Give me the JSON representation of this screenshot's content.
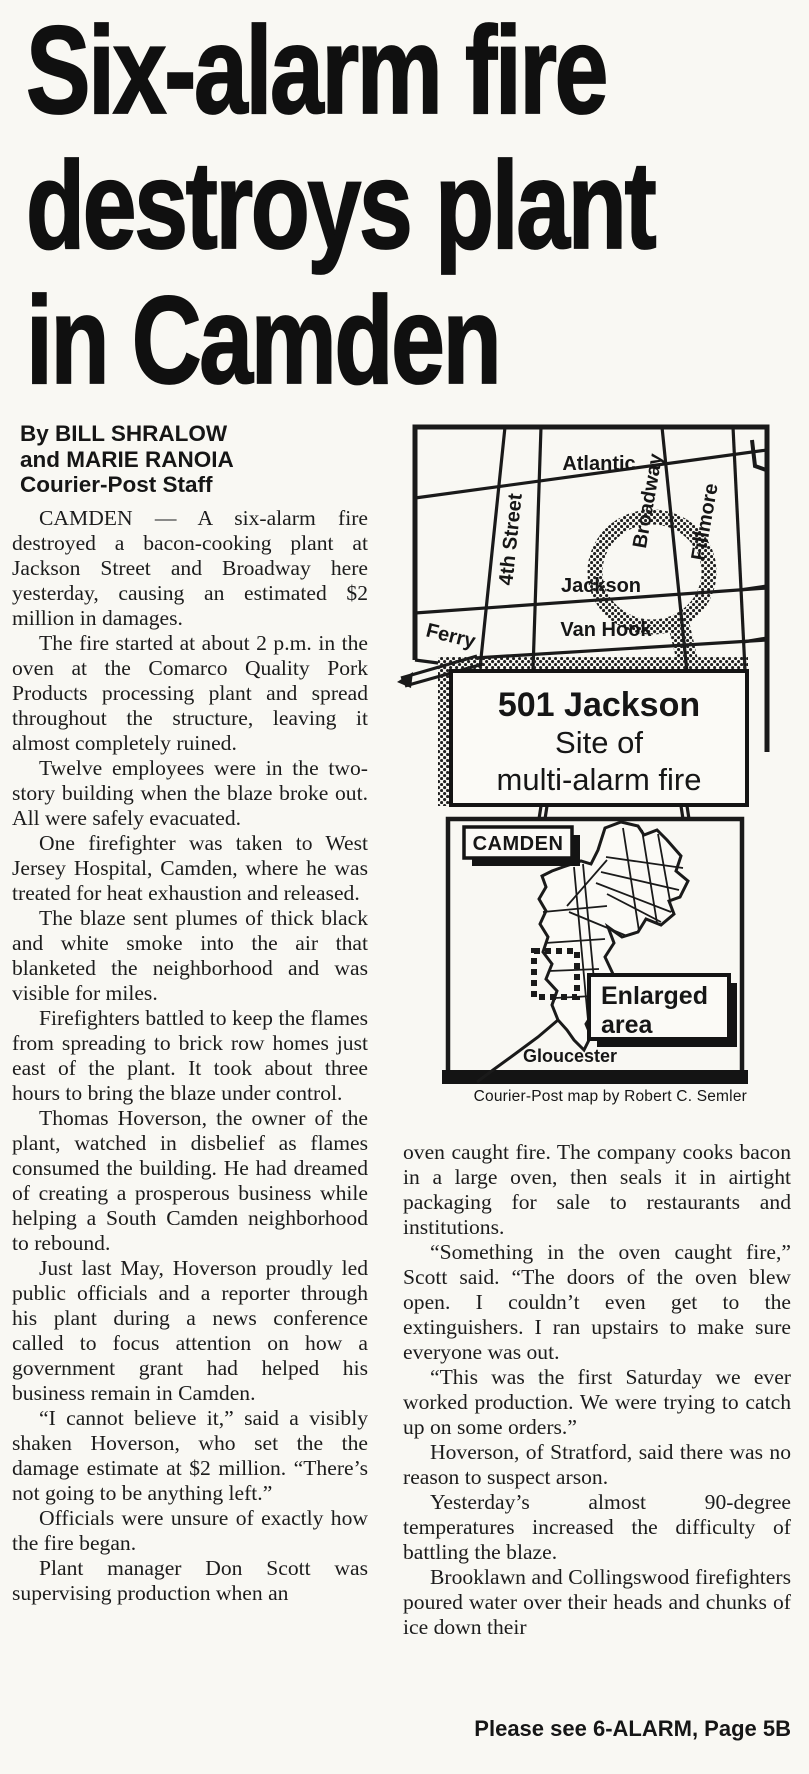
{
  "article": {
    "headline_lines": [
      "Six-alarm fire",
      "destroys plant",
      "in Camden"
    ],
    "byline_lines": [
      "By BILL SHRALOW",
      "and MARIE RANOIA",
      "Courier-Post Staff"
    ],
    "left_column_paragraphs": [
      "CAMDEN — A six-alarm fire destroyed a bacon-cooking plant at Jackson Street and Broadway here yesterday, causing an estimated $2 million in damages.",
      "The fire started at about 2 p.m. in the oven at the Comarco Quality Pork Products processing plant and spread throughout the structure, leaving it almost completely ruined.",
      "Twelve employees were in the two-story building when the blaze broke out. All were safely evacuated.",
      "One firefighter was taken to West Jersey Hospital, Camden, where he was treated for heat exhaustion and released.",
      "The blaze sent plumes of thick black and white smoke into the air that blanketed the neighborhood and was visible for miles.",
      "Firefighters battled to keep the flames from spreading to brick row homes just east of the plant. It took about three hours to bring the blaze under control.",
      "Thomas Hoverson, the owner of the plant, watched in disbelief as flames consumed the building. He had dreamed of creating a prosperous business while helping a South Camden neighborhood to rebound.",
      "Just last May, Hoverson proudly led public officials and a reporter through his plant during a news conference called to focus attention on how a government grant had helped his business remain in Camden.",
      "“I cannot believe it,” said a visibly shaken Hoverson, who set the the damage estimate at $2 million. “There’s not going to be anything left.”",
      "Officials were unsure of exactly how the fire began.",
      "Plant manager Don Scott was supervising production when an"
    ],
    "right_column_paragraphs": [
      "oven caught fire. The company cooks bacon in a large oven, then seals it in airtight packaging for sale to restaurants and institutions.",
      "“Something in the oven caught fire,” Scott said. “The doors of the oven blew open. I couldn’t even get to the extinguishers. I ran upstairs to make sure everyone was out.",
      "“This was the first Saturday we ever worked production. We were trying to catch up on some orders.”",
      "Hoverson, of Stratford, said there was no reason to suspect arson.",
      "Yesterday’s almost 90-degree temperatures increased the difficulty of battling the blaze.",
      "Brooklawn and Collingswood firefighters poured water over their heads and chunks of ice down their"
    ],
    "continuation_notice": "Please see 6-ALARM, Page 5B"
  },
  "map": {
    "streets": {
      "atlantic": "Atlantic",
      "fourth_street": "4th Street",
      "broadway": "Broadway",
      "fillmore": "Fillmore",
      "jackson": "Jackson",
      "van_hook": "Van Hook",
      "ferry": "Ferry"
    },
    "callout_lines": [
      "501 Jackson",
      "Site of",
      "multi-alarm fire"
    ],
    "locator": {
      "city_label": "CAMDEN",
      "enlarged_area_lines": [
        "Enlarged",
        "area"
      ],
      "neighbor_label": "Gloucester"
    },
    "credit": "Courier-Post map by Robert C. Semler",
    "ink_color": "#1a1a1a",
    "paper_color": "#f9f8f3"
  }
}
